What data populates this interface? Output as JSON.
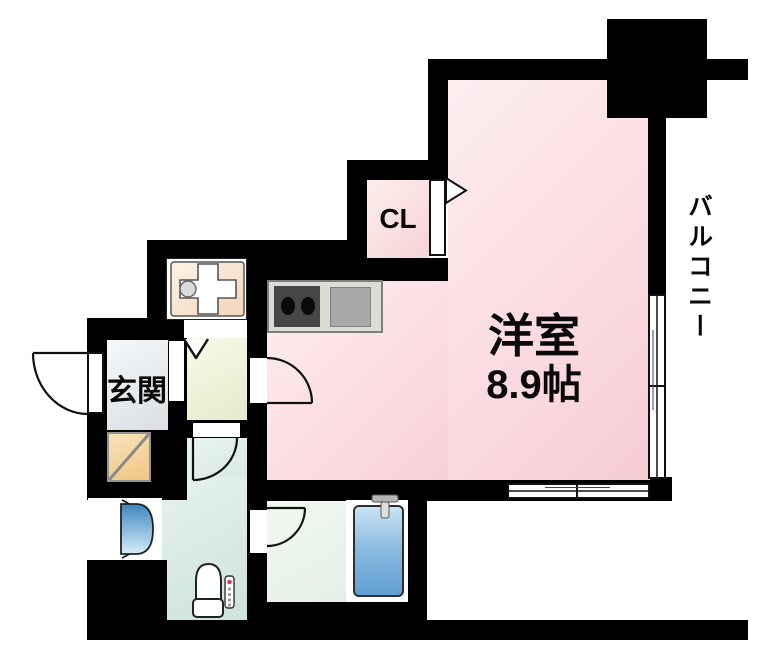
{
  "rooms": {
    "living": {
      "name": "洋室",
      "size": "8.9帖"
    },
    "closet": {
      "label": "CL"
    },
    "entrance": {
      "label": "玄関"
    },
    "balcony": {
      "label": "バルコニー"
    }
  },
  "icons": [
    "stove-burners-icon",
    "kitchen-sink-icon",
    "vanity-cross-icon",
    "toilet-icon",
    "bathtub-icon",
    "faucet-icon",
    "washbasin-icon",
    "washer-space-icon",
    "door-swing-arc",
    "sliding-window-icon",
    "closet-door-triangle",
    "entry-v-mark"
  ],
  "palette": {
    "wall": "#000000",
    "living_pink": "#f9d4da",
    "closet_pink": "#f8d6da",
    "entrance_gray": "#e2e6ea",
    "hallway_green": "#edf2d6",
    "toilet_teal": "#d8eae5",
    "bathroom_green": "#eef5ef",
    "washer_orange": "#f3d69e",
    "tub_blue": "#66a4d4",
    "sink_blue": "#4a8ec6",
    "vanity_beige": "#f6e2cd",
    "stove_dark": "#474747",
    "counter_gray": "#a8a8a8"
  }
}
